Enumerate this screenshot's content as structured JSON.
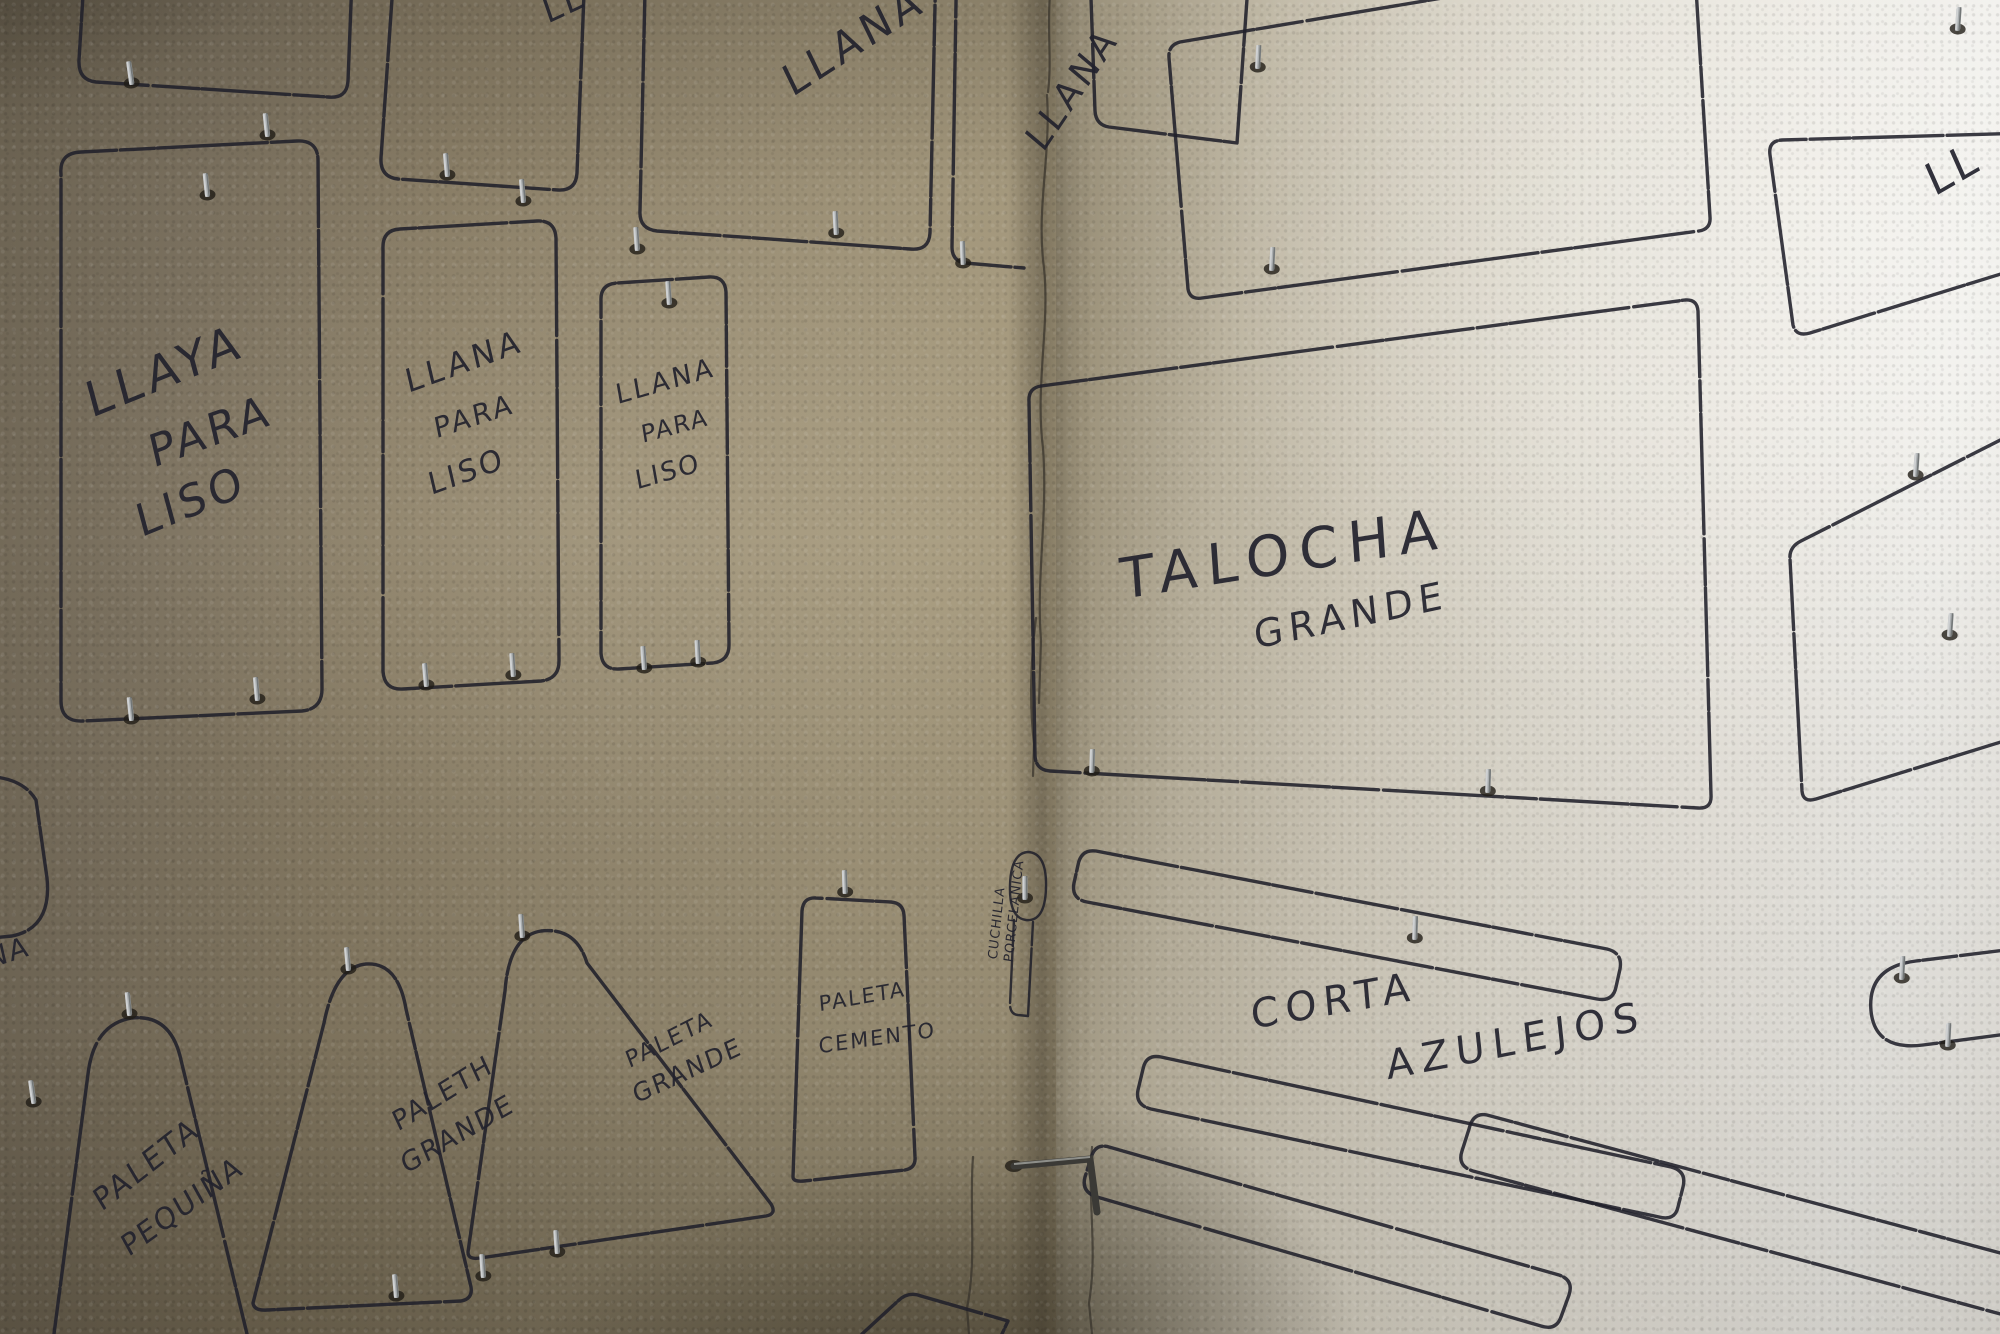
{
  "labels": {
    "top_edge_partial": "LL",
    "top_llana": "LLANA",
    "corner_llana": "LLANA",
    "left_edge_partial": "NA",
    "right_edge_partial": "LL",
    "panel_1": {
      "line1": "LLAYA",
      "line2": "PARA",
      "line3": "LISO"
    },
    "panel_2": {
      "line1": "LLANA",
      "line2": "PARA",
      "line3": "LISO"
    },
    "panel_3": {
      "line1": "LLANA",
      "line2": "PARA",
      "line3": "LISO"
    },
    "talocha": {
      "line1": "TALOCHA",
      "line2": "GRANDE"
    },
    "cuchilla": {
      "line1": "CUCHILLA",
      "line2": "PORCELANICA"
    },
    "corta_azulejos": {
      "line1": "CORTA",
      "line2": "AZULEJOS"
    },
    "paleta_pequena": {
      "line1": "PALETA",
      "line2": "PEQUIÑA"
    },
    "paleth_grande": {
      "line1": "PALETH",
      "line2": "GRANDE"
    },
    "paleta_grande": {
      "line1": "PALETA",
      "line2": "GRANDE"
    },
    "paleta_cemento": {
      "line1": "PALETA",
      "line2": "CEMENTO"
    }
  },
  "colors": {
    "ink": "#20202a",
    "left_wall": "#8d8169",
    "right_wall": "#eae7e0",
    "hook_metal": "#a9adaf",
    "hook_shadow": "#211d16"
  }
}
